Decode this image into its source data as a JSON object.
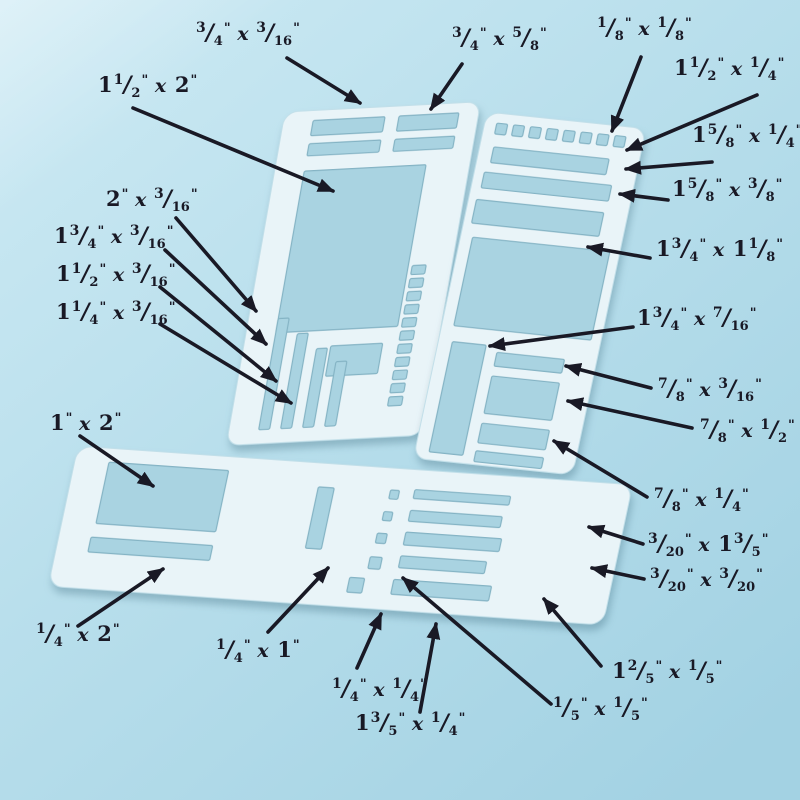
{
  "scene": {
    "title": "stencil dimension diagram",
    "background_top": "#cdeaf4",
    "background_mid": "#b9dfec",
    "background_bottom": "#a3d2e3",
    "panel_fill": "#e9f4f8",
    "panel_edge": "#c2dfe9",
    "cutout_fill": "#a9d3e1",
    "cutout_edge": "#84b3c4",
    "ink": "#191925"
  },
  "panels": [
    {
      "name": "stencil-panel-left",
      "transform": "translate(285,112) rotate(-3) skewX(-13)",
      "w": 196,
      "h": 330,
      "rx": 13,
      "cutouts": [
        {
          "x": 30,
          "y": 10,
          "w": 72,
          "h": 15
        },
        {
          "x": 30,
          "y": 33,
          "w": 72,
          "h": 12
        },
        {
          "x": 116,
          "y": 10,
          "w": 60,
          "h": 15
        },
        {
          "x": 116,
          "y": 33,
          "w": 60,
          "h": 12
        },
        {
          "x": 30,
          "y": 60,
          "w": 122,
          "h": 160
        },
        {
          "x": 88,
          "y": 236,
          "w": 52,
          "h": 30
        },
        {
          "x": 30,
          "y": 206,
          "w": 11,
          "h": 110
        },
        {
          "x": 52,
          "y": 222,
          "w": 11,
          "h": 94
        },
        {
          "x": 74,
          "y": 238,
          "w": 11,
          "h": 78
        },
        {
          "x": 96,
          "y": 252,
          "w": 11,
          "h": 64
        },
        {
          "x": 156,
          "y": 160,
          "w": 14,
          "h": 9
        },
        {
          "x": 156,
          "y": 173,
          "w": 14,
          "h": 9
        },
        {
          "x": 156,
          "y": 186,
          "w": 14,
          "h": 9
        },
        {
          "x": 156,
          "y": 199,
          "w": 14,
          "h": 9
        },
        {
          "x": 156,
          "y": 212,
          "w": 14,
          "h": 9
        },
        {
          "x": 156,
          "y": 225,
          "w": 14,
          "h": 9
        },
        {
          "x": 156,
          "y": 238,
          "w": 14,
          "h": 9
        },
        {
          "x": 156,
          "y": 251,
          "w": 14,
          "h": 9
        },
        {
          "x": 156,
          "y": 264,
          "w": 14,
          "h": 9
        },
        {
          "x": 156,
          "y": 277,
          "w": 14,
          "h": 9
        },
        {
          "x": 156,
          "y": 290,
          "w": 14,
          "h": 9
        }
      ]
    },
    {
      "name": "stencil-panel-right",
      "transform": "translate(487,112) rotate(6) skewX(-6)",
      "w": 160,
      "h": 352,
      "rx": 13,
      "cutouts": [
        {
          "x": 12,
          "y": 10,
          "w": 11,
          "h": 11
        },
        {
          "x": 29,
          "y": 10,
          "w": 11,
          "h": 11
        },
        {
          "x": 46,
          "y": 10,
          "w": 11,
          "h": 11
        },
        {
          "x": 63,
          "y": 10,
          "w": 11,
          "h": 11
        },
        {
          "x": 80,
          "y": 10,
          "w": 11,
          "h": 11
        },
        {
          "x": 97,
          "y": 10,
          "w": 11,
          "h": 11
        },
        {
          "x": 114,
          "y": 10,
          "w": 11,
          "h": 11
        },
        {
          "x": 131,
          "y": 10,
          "w": 11,
          "h": 11
        },
        {
          "x": 14,
          "y": 34,
          "w": 116,
          "h": 16
        },
        {
          "x": 10,
          "y": 60,
          "w": 128,
          "h": 16
        },
        {
          "x": 8,
          "y": 88,
          "w": 128,
          "h": 24
        },
        {
          "x": 12,
          "y": 126,
          "w": 138,
          "h": 90
        },
        {
          "x": 14,
          "y": 232,
          "w": 34,
          "h": 112
        },
        {
          "x": 60,
          "y": 238,
          "w": 68,
          "h": 14
        },
        {
          "x": 60,
          "y": 262,
          "w": 68,
          "h": 38
        },
        {
          "x": 60,
          "y": 310,
          "w": 68,
          "h": 20
        },
        {
          "x": 60,
          "y": 338,
          "w": 68,
          "h": 11
        }
      ]
    },
    {
      "name": "stencil-panel-bottom",
      "transform": "translate(78,446) rotate(4) skewX(-8)",
      "w": 556,
      "h": 142,
      "rx": 14,
      "cutouts": [
        {
          "x": 34,
          "y": 14,
          "w": 120,
          "h": 62
        },
        {
          "x": 32,
          "y": 90,
          "w": 122,
          "h": 15
        },
        {
          "x": 246,
          "y": 24,
          "w": 16,
          "h": 62
        },
        {
          "x": 318,
          "y": 22,
          "w": 9,
          "h": 9
        },
        {
          "x": 316,
          "y": 44,
          "w": 9,
          "h": 9
        },
        {
          "x": 314,
          "y": 66,
          "w": 10,
          "h": 10
        },
        {
          "x": 312,
          "y": 90,
          "w": 12,
          "h": 12
        },
        {
          "x": 296,
          "y": 112,
          "w": 15,
          "h": 15
        },
        {
          "x": 342,
          "y": 20,
          "w": 96,
          "h": 9
        },
        {
          "x": 342,
          "y": 41,
          "w": 92,
          "h": 11
        },
        {
          "x": 342,
          "y": 63,
          "w": 96,
          "h": 13
        },
        {
          "x": 342,
          "y": 87,
          "w": 86,
          "h": 12
        },
        {
          "x": 340,
          "y": 111,
          "w": 98,
          "h": 15
        }
      ]
    }
  ],
  "annotations": [
    {
      "label": "3/4\" x 3/16\"",
      "x": 196,
      "y": 40,
      "arrow": [
        287,
        58,
        360,
        103
      ]
    },
    {
      "label": "3/4\" x 5/8\"",
      "x": 452,
      "y": 45,
      "arrow": [
        462,
        64,
        431,
        109
      ]
    },
    {
      "label": "1/8\" x 1/8\"",
      "x": 597,
      "y": 35,
      "arrow": [
        641,
        57,
        612,
        131
      ]
    },
    {
      "label": "1 1/2\" x 2\"",
      "x": 98,
      "y": 92,
      "arrow": [
        133,
        108,
        333,
        191
      ]
    },
    {
      "label": "1 1/2\" x 1/4\"",
      "x": 674,
      "y": 75,
      "arrow": [
        757,
        95,
        627,
        150
      ]
    },
    {
      "label": "1 5/8\" x 1/4\"",
      "x": 692,
      "y": 142,
      "arrow": [
        712,
        162,
        626,
        169
      ]
    },
    {
      "label": "1 5/8\" x 3/8\"",
      "x": 672,
      "y": 196,
      "arrow": [
        668,
        200,
        620,
        194
      ]
    },
    {
      "label": "2\" x 3/16\"",
      "x": 106,
      "y": 206,
      "arrow": [
        176,
        218,
        256,
        311
      ]
    },
    {
      "label": "1 3/4\" x 3/16\"",
      "x": 54,
      "y": 243,
      "arrow": [
        165,
        250,
        266,
        344
      ]
    },
    {
      "label": "1 1/2\" x 3/16\"",
      "x": 56,
      "y": 281,
      "arrow": [
        160,
        287,
        276,
        381
      ]
    },
    {
      "label": "1 1/4\" x 3/16\"",
      "x": 56,
      "y": 319,
      "arrow": [
        160,
        324,
        291,
        403
      ]
    },
    {
      "label": "1 3/4\" x 1 1/8\"",
      "x": 656,
      "y": 256,
      "arrow": [
        650,
        258,
        588,
        247
      ]
    },
    {
      "label": "1 3/4\" x 7/16\"",
      "x": 637,
      "y": 325,
      "arrow": [
        633,
        327,
        490,
        346
      ]
    },
    {
      "label": "7/8\" x 3/16\"",
      "x": 658,
      "y": 396,
      "arrow": [
        651,
        388,
        566,
        366
      ]
    },
    {
      "label": "7/8\" x 1/2\"",
      "x": 700,
      "y": 437,
      "arrow": [
        692,
        428,
        568,
        401
      ]
    },
    {
      "label": "7/8\" x 1/4\"",
      "x": 654,
      "y": 506,
      "arrow": [
        647,
        497,
        554,
        441
      ]
    },
    {
      "label": "3/20\" x 1 3/5\"",
      "x": 648,
      "y": 551,
      "arrow": [
        643,
        544,
        589,
        527
      ]
    },
    {
      "label": "3/20\" x 3/20\"",
      "x": 650,
      "y": 586,
      "arrow": [
        644,
        579,
        592,
        568
      ]
    },
    {
      "label": "1 2/5\" x 1/5\"",
      "x": 612,
      "y": 678,
      "arrow": [
        601,
        666,
        544,
        599
      ]
    },
    {
      "label": "1/5\" x 1/5\"",
      "x": 553,
      "y": 715,
      "arrow": [
        551,
        704,
        403,
        578
      ]
    },
    {
      "label": "1 3/5\" x 1/4\"",
      "x": 355,
      "y": 730,
      "arrow": [
        420,
        712,
        436,
        624
      ]
    },
    {
      "label": "1/4\" x 1/4\"",
      "x": 332,
      "y": 696,
      "arrow": [
        357,
        668,
        381,
        614
      ]
    },
    {
      "label": "1/4\" x 1\"",
      "x": 216,
      "y": 657,
      "arrow": [
        268,
        632,
        328,
        568
      ]
    },
    {
      "label": "1/4\" x 2\"",
      "x": 36,
      "y": 641,
      "arrow": [
        78,
        626,
        163,
        569
      ]
    },
    {
      "label": "1\" x 2\"",
      "x": 50,
      "y": 430,
      "arrow": [
        80,
        436,
        153,
        486
      ]
    }
  ]
}
